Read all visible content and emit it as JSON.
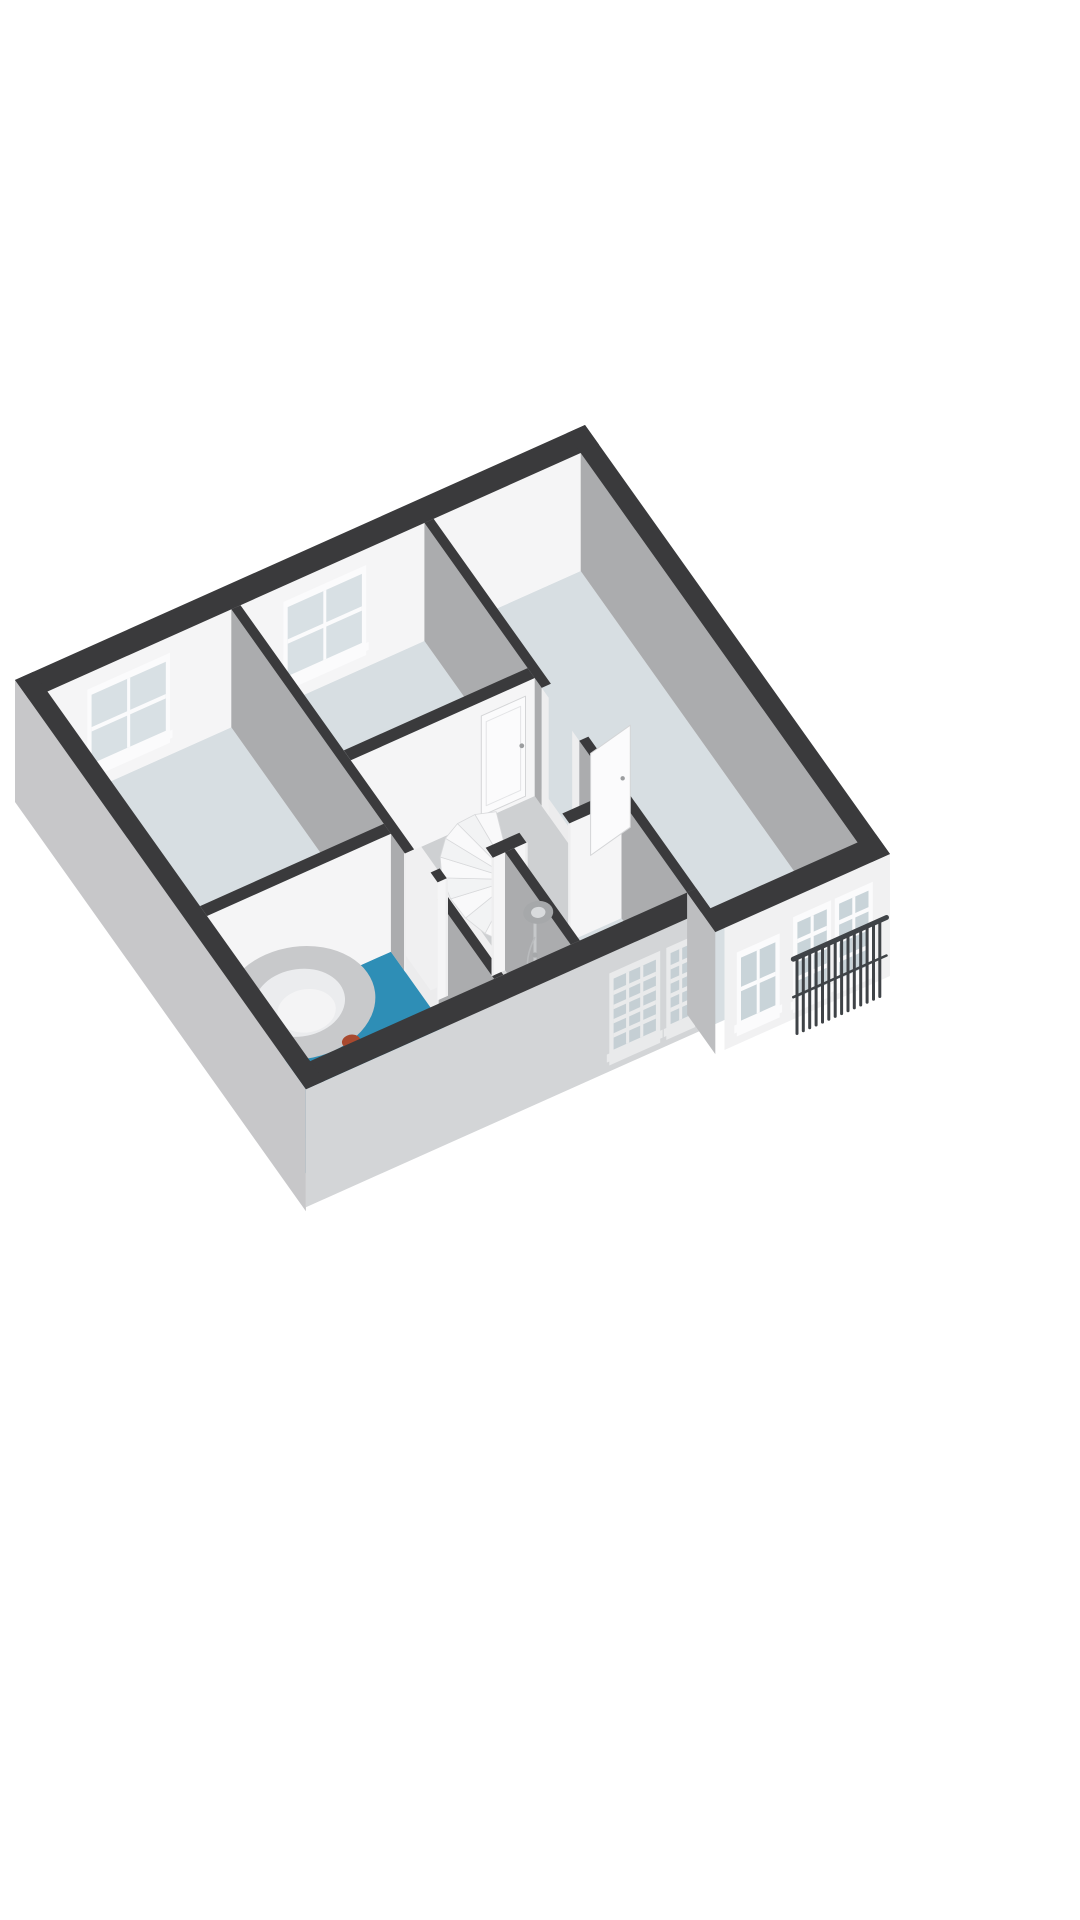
{
  "app": {
    "type": "3d-floorplan-render",
    "title": "3D floor plan - upper floor cutaway",
    "background": "#ffffff"
  },
  "scene": {
    "view": "axonometric-cutaway",
    "walls_cut": true,
    "labels_shown": false,
    "furniture_shown": false
  },
  "colors": {
    "background": "#ffffff",
    "wall_top": "#3a3a3c",
    "wall_white": "#f5f5f6",
    "wall_white_dim": "#ededee",
    "wall_gray": "#abacae",
    "facade_gray": "#c7c7c9",
    "facade_white": "#f1f1f2",
    "facade_recessed": "#d3d5d7",
    "facade_return_gray": "#bdbec0",
    "floor_underlay": "#ececed",
    "floor_room": "#d7dee2",
    "floor_hall": "#f0f0f1",
    "floor_stair_zone": "#ced0d2",
    "floor_shower": "#dadbdc",
    "floor_bathroom": "#2e8eb6",
    "glass_interior": "#d8e0e4",
    "glass_exterior": "#c9d4d9",
    "glass_recessed": "#c5cfd4",
    "frame_white": "#fbfbfc",
    "frame_recessed": "#e9eaeb",
    "stair_tread_a": "#f9f9fa",
    "stair_tread_b": "#f2f3f4",
    "stair_edge": "#d8d9db",
    "stair_riser": "#e4e5e7",
    "stair_void": "#b3b5b7",
    "newel_fill": "#ebebec",
    "railing_dark": "#3f4347",
    "metal_light": "#c6c8ca",
    "metal_mid": "#a6a8aa",
    "tub_rim": "#fdfdfd",
    "tub_inner": "#ebecee",
    "tub_bottom": "#f4f4f5",
    "accent_red": "#a8492f",
    "jamb_white": "#eeeeef",
    "door_leaf": "#fbfbfc",
    "door_edge": "#d4d5d7",
    "handle_gray": "#9b9d9f"
  },
  "rooms": [
    {
      "id": "bedroom-left",
      "floor_color_key": "floor_room"
    },
    {
      "id": "bedroom-top",
      "floor_color_key": "floor_room"
    },
    {
      "id": "room-right",
      "floor_color_key": "floor_room"
    },
    {
      "id": "landing-hall",
      "floor_color_key": "floor_hall"
    },
    {
      "id": "stair-zone",
      "floor_color_key": "floor_stair_zone"
    },
    {
      "id": "bathroom",
      "floor_color_key": "floor_bathroom"
    },
    {
      "id": "shower-room",
      "floor_color_key": "floor_shower"
    },
    {
      "id": "room-south",
      "floor_color_key": "floor_room"
    }
  ],
  "openings": {
    "windows": [
      {
        "id": "nw-window-left",
        "type": "sash",
        "panes": "2x2",
        "wall": "northwest-facade"
      },
      {
        "id": "nw-window-top",
        "type": "sash",
        "panes": "2x2",
        "wall": "northwest-facade"
      },
      {
        "id": "se-recessed-window-wide",
        "type": "paned",
        "panes": "3x5",
        "wall": "southeast-recessed-facade"
      },
      {
        "id": "se-recessed-window-narrow",
        "type": "paned",
        "panes": "2x5",
        "wall": "southeast-recessed-facade"
      },
      {
        "id": "se-sash-window",
        "type": "sash",
        "panes": "2x2",
        "wall": "southeast-facade"
      },
      {
        "id": "se-french-doors",
        "type": "glazed-double-door",
        "panes": "2x4 each",
        "wall": "southeast-facade"
      }
    ],
    "doors": [
      {
        "id": "door-bedroom-top",
        "state": "closed",
        "has_handle": true
      },
      {
        "id": "door-room-right",
        "state": "open",
        "has_handle": true
      },
      {
        "id": "door-bathroom",
        "state": "open-gap"
      },
      {
        "id": "door-shower-room",
        "state": "open-gap"
      },
      {
        "id": "door-room-south",
        "state": "open-gap"
      }
    ]
  },
  "fixtures": [
    {
      "id": "bathtub",
      "shape": "oval",
      "accent": "red-item"
    },
    {
      "id": "shower-set",
      "parts": [
        "riser-rail",
        "shower-head",
        "control-knob",
        "hand-shower"
      ]
    },
    {
      "id": "winder-staircase",
      "treads": 11,
      "descending_treads": 2
    },
    {
      "id": "juliet-railing",
      "bars": 14,
      "rails": 2
    }
  ]
}
